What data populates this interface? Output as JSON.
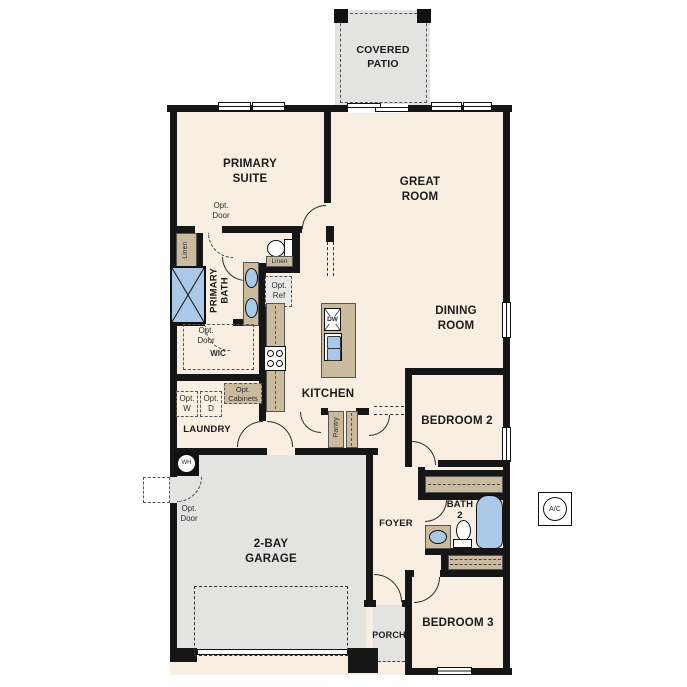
{
  "plan_title": "single-story floor plan",
  "colors": {
    "floor": "#f8efe2",
    "structure_gray": "#e3e3e2",
    "cabinet_tan": "#cabb9f",
    "fixture_blue": "#aac9e8",
    "wall": "#161616"
  },
  "labels": {
    "covered_patio": "COVERED PATIO",
    "primary_suite": "PRIMARY SUITE",
    "great_room": "GREAT ROOM",
    "dining_room": "DINING ROOM",
    "kitchen": "KITCHEN",
    "bedroom2": "BEDROOM 2",
    "bedroom3": "BEDROOM 3",
    "garage": "2-BAY GARAGE",
    "foyer": "FOYER",
    "porch": "PORCH",
    "laundry": "LAUNDRY",
    "wic": "WIC",
    "bath2": "BATH 2",
    "primary_bath": "PRIMARY BATH",
    "pantry": "Pantry",
    "linen_left": "Linen",
    "linen_mid": "Linen",
    "opt_door_primary": "Opt. Door",
    "opt_door_wic": "Opt. Door",
    "opt_door_garage": "Opt. Door",
    "opt_ref": "Opt. Ref",
    "opt_w": "Opt. W",
    "opt_d": "Opt. D",
    "opt_cabinets": "Opt. Cabinets",
    "dw": "DW",
    "wh": "WH",
    "ac": "A/C"
  }
}
